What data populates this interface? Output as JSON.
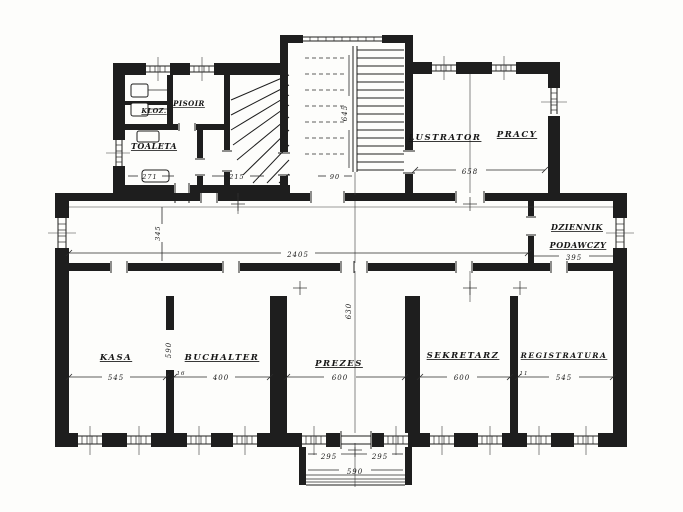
{
  "rooms": {
    "pisoir": "PISOIR",
    "kloz": "KLOZ.",
    "toaleta": "TOALETA",
    "lustrator_word1": "LUSTRATOR",
    "lustrator_word2": "PRACY",
    "dziennik_line1": "DZIENNIK",
    "dziennik_line2": "PODAWCZY",
    "kasa": "KASA",
    "buchalter": "BUCHALTER",
    "prezes": "PREZES",
    "sekretarz": "SEKRETARZ",
    "registratura": "REGISTRATURA"
  },
  "dims": {
    "kasa_width": "545",
    "buchalter_width": "400",
    "prezes_width": "600",
    "sekretarz_width": "600",
    "registratura_width": "545",
    "corridor_length": "2405",
    "corridor_width": "345",
    "dziennik_width": "395",
    "lustrator_width": "658",
    "stair_run": "645",
    "prezes_depth": "630",
    "room_depth": "590",
    "toilet_width": "271",
    "stair_width": "215",
    "landing_width": "90",
    "porch_left": "295",
    "porch_right": "295",
    "porch_width": "590",
    "mark_buchalter": "16",
    "mark_registratura": "11"
  },
  "colors": {
    "ink": "#1e1e1e",
    "paper": "#fdfdfb"
  }
}
